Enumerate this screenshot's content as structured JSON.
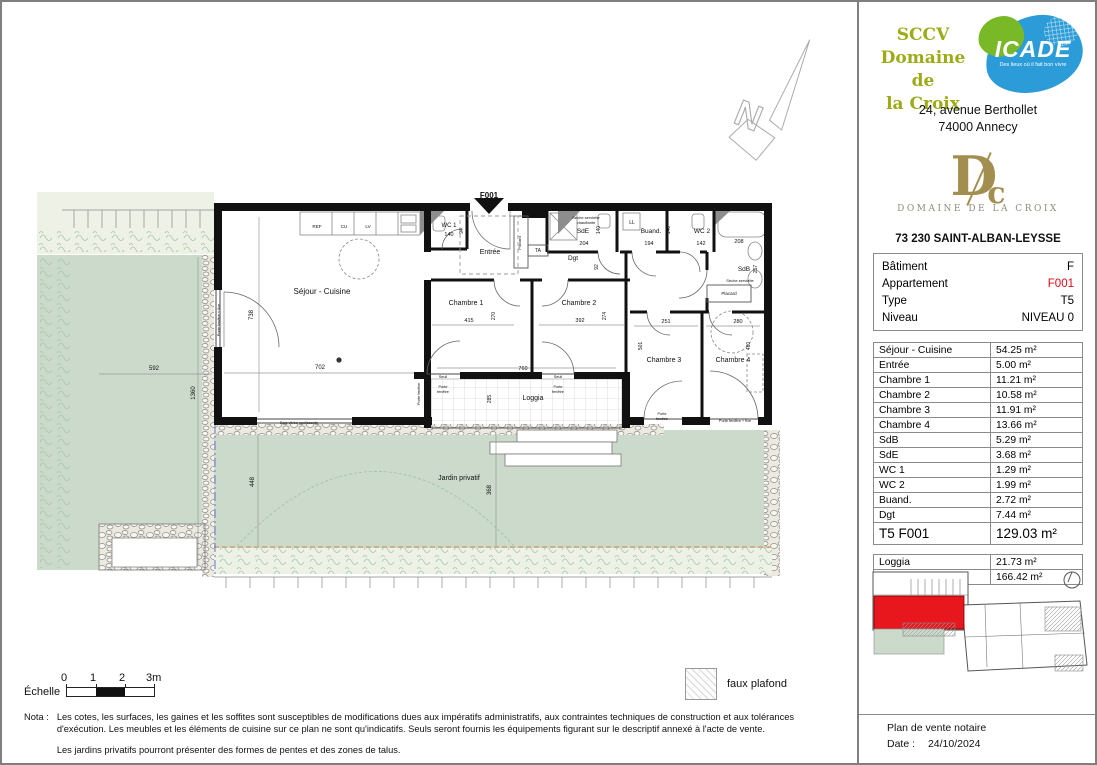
{
  "colors": {
    "accent_red": "#e30613",
    "logo_olive": "#9cab17",
    "icade_blue": "#2b9cd8",
    "icade_green": "#79b928",
    "gold": "#a28f50",
    "garden_green": "#ccdacb"
  },
  "header": {
    "company_line1": "SCCV",
    "company_line2": "Domaine de",
    "company_line3": "la Croix",
    "icade": {
      "name": "ICADE",
      "tagline": "Des lieux où il fait bon vivre"
    },
    "address_line1": "24, avenue Berthollet",
    "address_line2": "74000 Annecy",
    "brand": {
      "monogram_d": "D",
      "monogram_c": "c",
      "name": "DOMAINE DE LA CROIX",
      "city": "73 230 SAINT-ALBAN-LEYSSE"
    }
  },
  "info": {
    "rows": [
      {
        "label": "Bâtiment",
        "value": "F"
      },
      {
        "label": "Appartement",
        "value": "F001",
        "red": true
      },
      {
        "label": "Type",
        "value": "T5"
      },
      {
        "label": "Niveau",
        "value": "NIVEAU 0"
      }
    ]
  },
  "areas": {
    "rows": [
      {
        "label": "Séjour - Cuisine",
        "value": "54.25 m²"
      },
      {
        "label": "Entrée",
        "value": "5.00 m²"
      },
      {
        "label": "Chambre 1",
        "value": "11.21 m²"
      },
      {
        "label": "Chambre 2",
        "value": "10.58 m²"
      },
      {
        "label": "Chambre 3",
        "value": "11.91 m²"
      },
      {
        "label": "Chambre 4",
        "value": "13.66 m²"
      },
      {
        "label": "SdB",
        "value": "5.29 m²"
      },
      {
        "label": "SdE",
        "value": "3.68 m²"
      },
      {
        "label": "WC 1",
        "value": "1.29 m²"
      },
      {
        "label": "WC 2",
        "value": "1.99 m²"
      },
      {
        "label": "Buand.",
        "value": "2.72 m²"
      },
      {
        "label": "Dgt",
        "value": "7.44 m²"
      }
    ],
    "total": {
      "label": "T5 F001",
      "value": "129.03 m²"
    }
  },
  "annex": {
    "rows": [
      {
        "label": "Loggia",
        "value": "21.73 m²"
      },
      {
        "label": "Jardin privatif",
        "value": "166.42 m²"
      }
    ]
  },
  "footer": {
    "title": "Plan de vente notaire",
    "date_label": "Date :",
    "date": "24/10/2024"
  },
  "legend": {
    "faux_plafond": "faux plafond"
  },
  "scale": {
    "label": "Échelle",
    "t0": "0",
    "t1": "1",
    "t2": "2",
    "t3": "3m"
  },
  "nota": {
    "label": "Nota :",
    "par1": "Les cotes, les surfaces, les gaines et les soffites sont susceptibles de modifications dues aux impératifs administratifs, aux contraintes techniques de construction et aux tolérances d'exécution. Les meubles et les éléments de cuisine sur ce plan ne sont qu'indicatifs. Seuls seront fournis les équipements figurant sur le descriptif annexé à l'acte de vente.",
    "par2": "Les jardins privatifs pourront présenter des formes de pentes et des zones de talus."
  },
  "plan": {
    "labels": [
      {
        "t": "F001",
        "x": 487,
        "y": 196,
        "s": 8,
        "b": 1
      },
      {
        "t": "N",
        "x": 742,
        "y": 125,
        "s": 36,
        "r": 22,
        "cls": "compass"
      },
      {
        "t": "Séjour - Cuisine",
        "x": 320,
        "y": 292,
        "s": 8
      },
      {
        "t": "702",
        "x": 318,
        "y": 367,
        "s": 6
      },
      {
        "t": "738",
        "x": 251,
        "y": 313,
        "s": 6,
        "r": -90
      },
      {
        "t": "REF",
        "x": 315,
        "y": 226,
        "s": 4.6
      },
      {
        "t": "CU",
        "x": 342,
        "y": 226,
        "s": 4.6
      },
      {
        "t": "LV",
        "x": 366,
        "y": 226,
        "s": 4.6
      },
      {
        "t": "WC 1",
        "x": 447,
        "y": 225,
        "s": 6
      },
      {
        "t": "140",
        "x": 447,
        "y": 234,
        "s": 5.5
      },
      {
        "t": "94",
        "x": 461,
        "y": 229,
        "s": 5,
        "r": -90
      },
      {
        "t": "Entrée",
        "x": 488,
        "y": 252,
        "s": 7
      },
      {
        "t": "Placard",
        "x": 519,
        "y": 241,
        "s": 4,
        "r": -90
      },
      {
        "t": "TA",
        "x": 536,
        "y": 250,
        "s": 5
      },
      {
        "t": "Sèche serviette",
        "x": 584,
        "y": 217,
        "s": 4
      },
      {
        "t": "chauffante",
        "x": 584,
        "y": 222,
        "s": 4
      },
      {
        "t": "SdE",
        "x": 581,
        "y": 231,
        "s": 6.5
      },
      {
        "t": "140",
        "x": 598,
        "y": 228,
        "s": 5,
        "r": -90
      },
      {
        "t": "204",
        "x": 582,
        "y": 243,
        "s": 5.5
      },
      {
        "t": "LL",
        "x": 630,
        "y": 222,
        "s": 5
      },
      {
        "t": "Buand.",
        "x": 649,
        "y": 231,
        "s": 6.5
      },
      {
        "t": "140",
        "x": 668,
        "y": 228,
        "s": 5,
        "r": -90
      },
      {
        "t": "194",
        "x": 647,
        "y": 243,
        "s": 5.5
      },
      {
        "t": "WC 2",
        "x": 700,
        "y": 231,
        "s": 6.5
      },
      {
        "t": "142",
        "x": 699,
        "y": 243,
        "s": 5.5
      },
      {
        "t": "208",
        "x": 737,
        "y": 241,
        "s": 5.5
      },
      {
        "t": "SdB",
        "x": 742,
        "y": 269,
        "s": 6.5
      },
      {
        "t": "257",
        "x": 755,
        "y": 267,
        "s": 5,
        "r": -90
      },
      {
        "t": "Sèche serviette",
        "x": 738,
        "y": 280,
        "s": 4
      },
      {
        "t": "Placard",
        "x": 727,
        "y": 293,
        "s": 4.5
      },
      {
        "t": "Dgt",
        "x": 571,
        "y": 258,
        "s": 6.5
      },
      {
        "t": "92",
        "x": 596,
        "y": 265,
        "s": 5,
        "r": -90
      },
      {
        "t": "Chambre 1",
        "x": 464,
        "y": 303,
        "s": 7
      },
      {
        "t": "415",
        "x": 467,
        "y": 320,
        "s": 5.5
      },
      {
        "t": "270",
        "x": 493,
        "y": 314,
        "s": 5,
        "r": -90
      },
      {
        "t": "Chambre 2",
        "x": 577,
        "y": 303,
        "s": 7
      },
      {
        "t": "392",
        "x": 578,
        "y": 320,
        "s": 5.5
      },
      {
        "t": "274",
        "x": 604,
        "y": 314,
        "s": 5,
        "r": -90
      },
      {
        "t": "251",
        "x": 664,
        "y": 321,
        "s": 5.5
      },
      {
        "t": "501",
        "x": 640,
        "y": 344,
        "s": 5,
        "r": -90
      },
      {
        "t": "Chambre 3",
        "x": 662,
        "y": 360,
        "s": 7
      },
      {
        "t": "280",
        "x": 736,
        "y": 321,
        "s": 5.5
      },
      {
        "t": "480",
        "x": 748,
        "y": 344,
        "s": 5,
        "r": -90
      },
      {
        "t": "Chambre 4",
        "x": 731,
        "y": 360,
        "s": 7
      },
      {
        "t": "760",
        "x": 521,
        "y": 368,
        "s": 5.5
      },
      {
        "t": "285",
        "x": 489,
        "y": 397,
        "s": 5,
        "r": -90
      },
      {
        "t": "Loggia",
        "x": 531,
        "y": 398,
        "s": 7
      },
      {
        "t": "Seuil",
        "x": 441,
        "y": 376,
        "s": 3.8
      },
      {
        "t": "Seuil",
        "x": 556,
        "y": 376,
        "s": 3.8
      },
      {
        "t": "Porte",
        "x": 441,
        "y": 386,
        "s": 3.8
      },
      {
        "t": "fenêtre",
        "x": 441,
        "y": 391,
        "s": 3.8
      },
      {
        "t": "Porte",
        "x": 556,
        "y": 386,
        "s": 3.8
      },
      {
        "t": "fenêtre",
        "x": 556,
        "y": 391,
        "s": 3.8
      },
      {
        "t": "Porte fenêtre",
        "x": 418,
        "y": 392,
        "s": 3.8,
        "r": -90
      },
      {
        "t": "Porte fenêtre + fixe",
        "x": 218,
        "y": 318,
        "s": 3.8,
        "r": -90
      },
      {
        "t": "Baie vitrée coulissante",
        "x": 297,
        "y": 422,
        "s": 3.8
      },
      {
        "t": "Porte",
        "x": 660,
        "y": 413,
        "s": 3.8
      },
      {
        "t": "fenêtre",
        "x": 660,
        "y": 418,
        "s": 3.8
      },
      {
        "t": "Porte fenêtre + fixe",
        "x": 733,
        "y": 420,
        "s": 3.8
      },
      {
        "t": "592",
        "x": 152,
        "y": 368,
        "s": 6
      },
      {
        "t": "1360",
        "x": 193,
        "y": 391,
        "s": 6,
        "r": -90
      },
      {
        "t": "448",
        "x": 252,
        "y": 480,
        "s": 6,
        "r": -90
      },
      {
        "t": "368",
        "x": 489,
        "y": 488,
        "s": 6,
        "r": -90
      },
      {
        "t": "Jardin privatif",
        "x": 457,
        "y": 478,
        "s": 7
      }
    ]
  }
}
